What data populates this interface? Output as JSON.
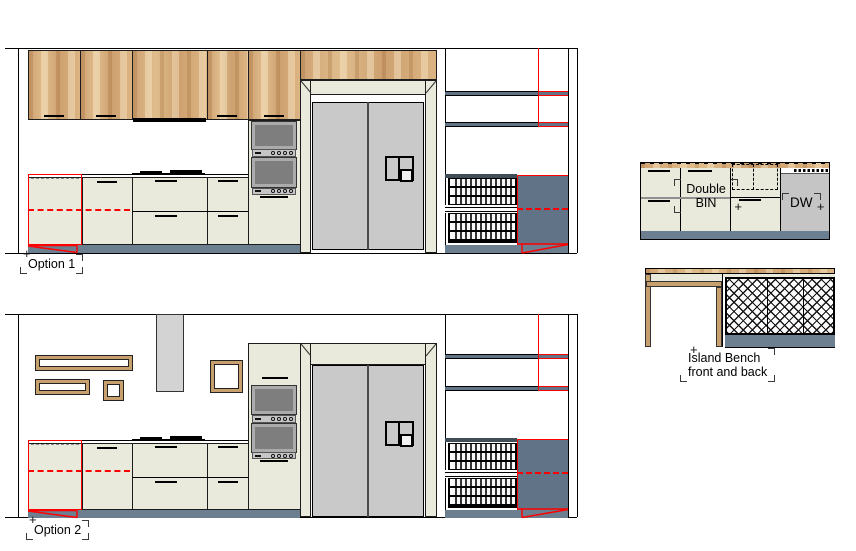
{
  "colors": {
    "red": "#FF0000",
    "cream": "#EAEADC",
    "wood_frame": "#C7A06E",
    "slate_kick": "#6B7F90",
    "slate_panel": "#617487",
    "fridge_gray": "#C9C9C9",
    "oven_gray": "#7E7E7E",
    "oven_trim": "#ABABAB",
    "strip_gray": "#C6C6C6",
    "hood_gray": "#D3D3D3",
    "dw_gray": "#C5C5C5",
    "dark_shelf": "#3F4D59"
  },
  "labels": {
    "option1": "Option 1",
    "option2": "Option 2",
    "island_caption_line1": "Island Bench",
    "island_caption_line2": "front and back",
    "double_bin_line1": "Double",
    "double_bin_line2": "BIN",
    "dw": "DW"
  },
  "icons": {
    "crosshair": "+"
  }
}
